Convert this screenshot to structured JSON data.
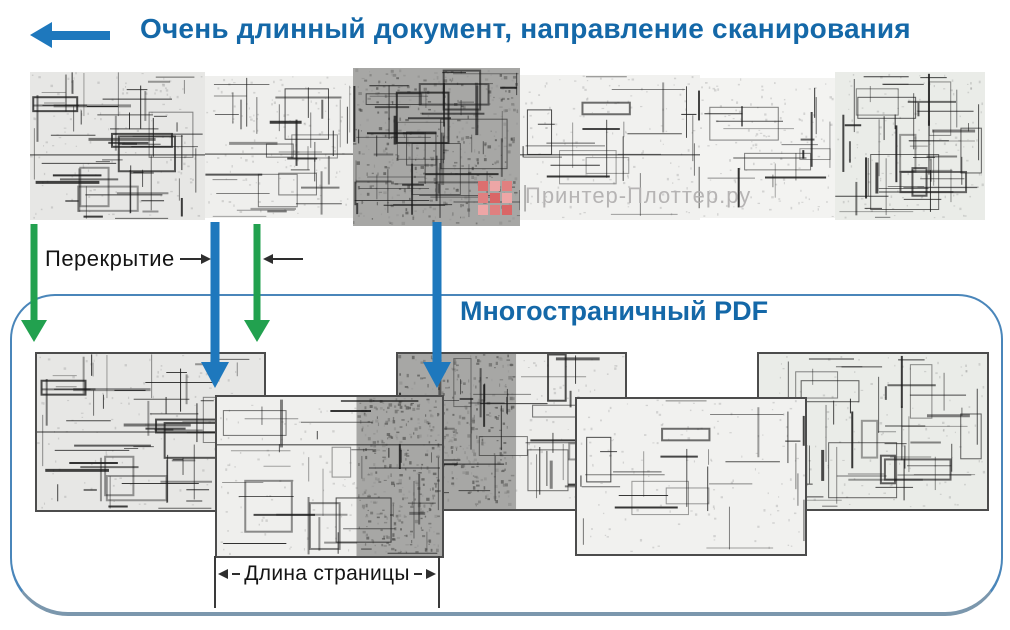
{
  "header": {
    "title": "Очень длинный документ, направление сканирования",
    "scan_direction_icon": "arrow-left-icon"
  },
  "annotations": {
    "overlap_label": "Перекрытие",
    "page_length_label": "Длина страницы"
  },
  "box": {
    "title": "Многостраничный PDF"
  },
  "watermark": {
    "text": "Принтер-Плоттер.ру",
    "logo_icon": "red-squares-grid-icon",
    "logo_colors": [
      "#dc6f6f",
      "#eda6a6",
      "#e08080",
      "#e08080",
      "#d96666",
      "#eda6a6",
      "#eda6a6",
      "#e08080",
      "#d96666"
    ]
  },
  "colors": {
    "title_blue": "#1468a8",
    "arrow_blue": "#1e78bd",
    "arrow_green": "#22a14f",
    "box_border": "#4a86ba",
    "box_border_bottom": "#7b97ad",
    "page_border": "#4c4c4c",
    "dim_ink": "#2e2e2e",
    "watermark_gray": "#b3b1b1"
  }
}
